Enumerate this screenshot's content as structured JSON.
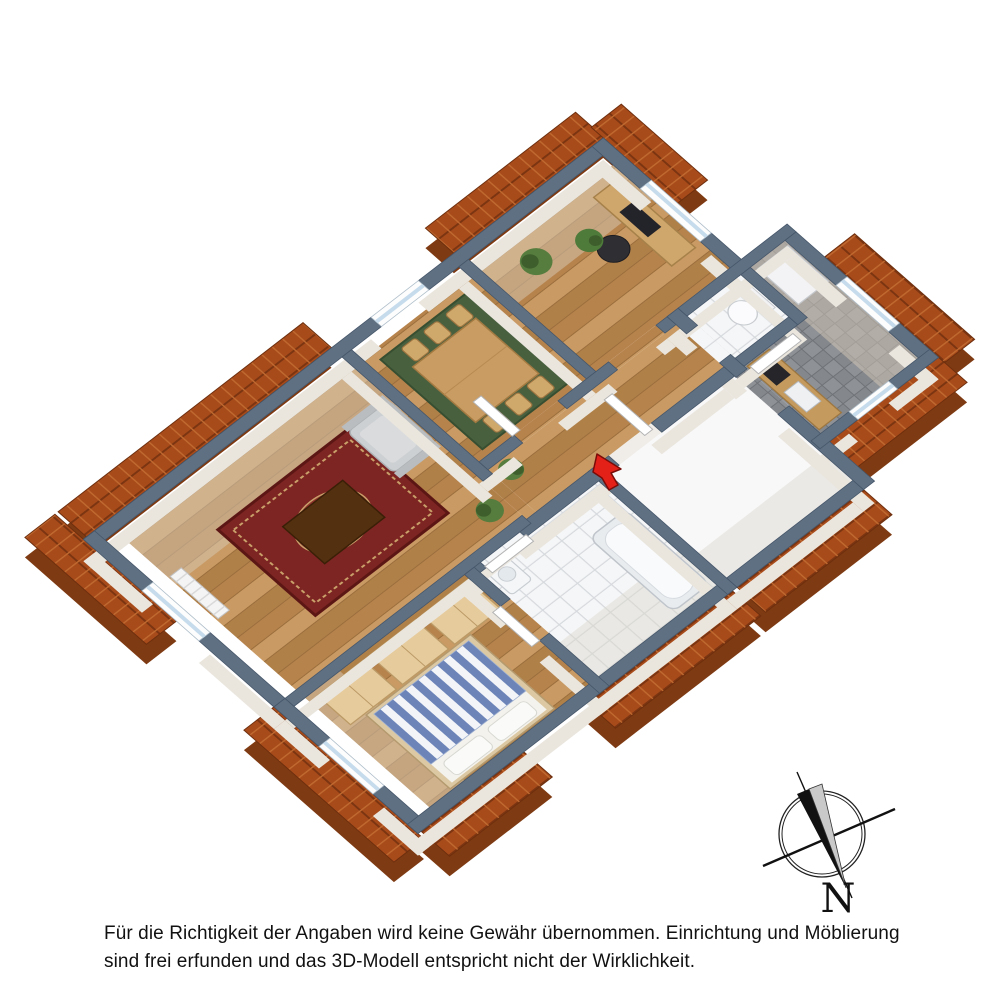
{
  "title": "3D floor plan rendering (attic apartment)",
  "disclaimer": {
    "line1": "Für die Richtigkeit der Angaben wird keine Gewähr übernommen. Einrichtung und Möblierung",
    "line2": "sind frei erfunden und das 3D-Modell entspricht nicht der Wirklichkeit."
  },
  "compass": {
    "north_label": "N",
    "needle_direction": "down-right",
    "style": "circle with crossing axis lines, half-black half-gray needle"
  },
  "entrance": {
    "marker": "red-arrow",
    "points_to": "apartment-entry-door",
    "color": "#e32119"
  },
  "floorplan": {
    "view": "isometric 3d cutaway, walls seen from above",
    "rooms": [
      {
        "id": "living-room",
        "floor": "wood",
        "furniture": [
          "oriental-red-rug",
          "dark-coffee-table",
          "gray-armchair",
          "radiator",
          "potted-plants"
        ]
      },
      {
        "id": "dining-room",
        "floor": "wood",
        "furniture": [
          "green-rug",
          "wooden-dining-table",
          "six-chairs"
        ]
      },
      {
        "id": "office",
        "floor": "wood",
        "furniture": [
          "desk",
          "computer-monitor",
          "office-chair",
          "potted-plant"
        ]
      },
      {
        "id": "hallway",
        "floor": "wood",
        "furniture": [
          "potted-plants"
        ]
      },
      {
        "id": "bedroom",
        "floor": "wood",
        "furniture": [
          "double-bed-blue-striped-duvet",
          "pillows",
          "wardrobe-cabinets"
        ]
      },
      {
        "id": "bathroom",
        "floor": "white-tile",
        "furniture": [
          "bathtub",
          "sink"
        ]
      },
      {
        "id": "wc",
        "floor": "white-tile",
        "furniture": [
          "toilet"
        ]
      },
      {
        "id": "kitchen",
        "floor": "gray-tile",
        "furniture": [
          "counter-with-cooktop-and-sink",
          "tall-white-cabinet"
        ]
      },
      {
        "id": "stair-landing",
        "floor": "white",
        "furniture": []
      }
    ],
    "colors": {
      "wood_floor": "#c1905a",
      "roof_tiles": "#a84b1b",
      "wall_top": "#5e7082",
      "wall_face": "#eae6de",
      "gray_tile": "#84878c",
      "white_tile": "#f5f6f7",
      "rug_red": "#7d2522",
      "rug_green": "#49603f",
      "duvet_blue": "#6c84b8",
      "arrow_red": "#e32119"
    }
  }
}
